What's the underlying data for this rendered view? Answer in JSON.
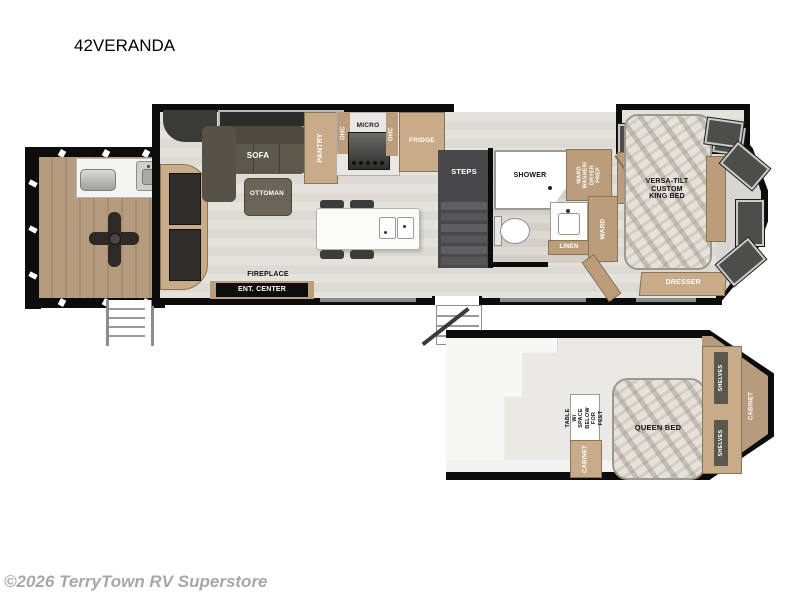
{
  "title": "42VERANDA",
  "footer": {
    "copyright": "©2026 TerryTown RV Superstore"
  },
  "colors": {
    "wall": "#0c0c0c",
    "cabinet_tan": "#bb9d7c",
    "sofa_olive": "#5d584c",
    "floor_light": "#e0ded8",
    "deck_wood": "#b59c7e",
    "window_dark": "#4d4d4b"
  },
  "main": {
    "sofa": "SOFA",
    "ottoman": "OTTOMAN",
    "pantry": "PANTRY",
    "ohc_left": "OHC",
    "micro": "MICRO",
    "ohc_right": "OHC",
    "fridge": "FRIDGE",
    "fireplace": "FIREPLACE",
    "ent_center": "ENT. CENTER",
    "steps": "STEPS",
    "shower": "SHOWER",
    "ward_washer": "WARD\nWASHER/\nDRYER\nPREP",
    "linen": "LINEN",
    "ward": "WARD",
    "king_bed": "VERSA-TILT\nCUSTOM\nKING BED",
    "dresser": "DRESSER"
  },
  "loft": {
    "table_note": "TABLE W/\nSPACE BELOW\nFOR FEET",
    "cabinet_left": "CABINET",
    "queen_bed": "QUEEN BED",
    "shelves_top": "SHELVES",
    "shelves_bottom": "SHELVES",
    "cabinet_right": "CABINET"
  }
}
